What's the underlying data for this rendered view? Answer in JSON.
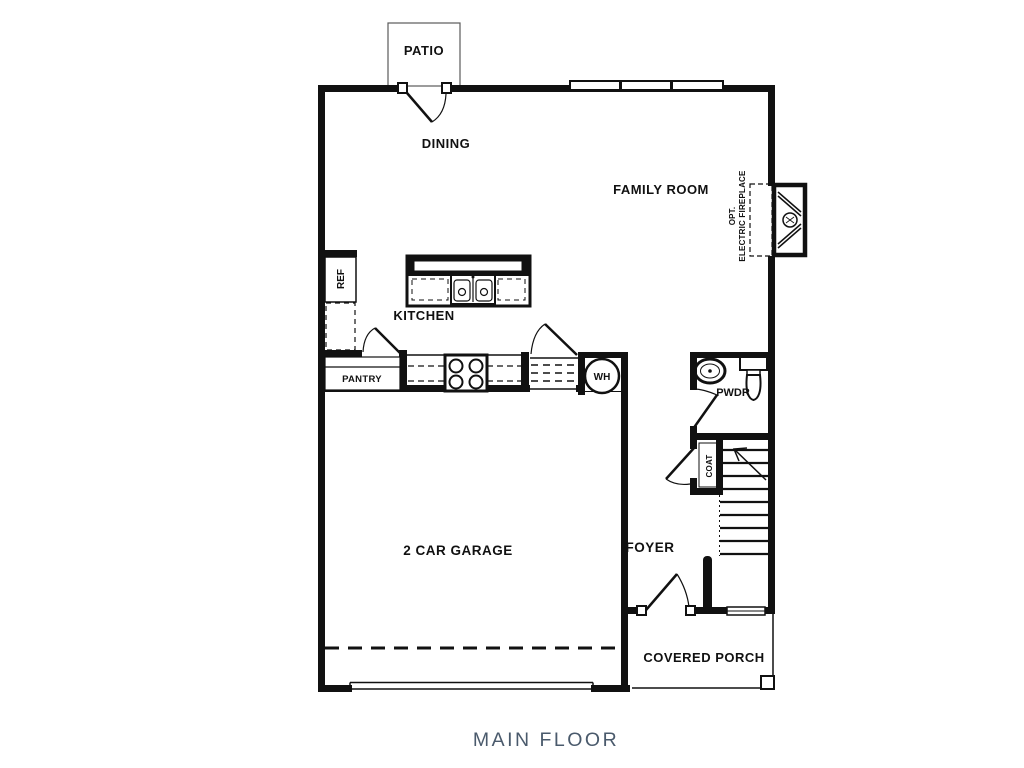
{
  "title": "MAIN FLOOR",
  "colors": {
    "line": "#111111",
    "title_text": "#4a5a6c",
    "paper": "#ffffff"
  },
  "rooms": {
    "patio": "PATIO",
    "dining": "DINING",
    "family_room": "FAMILY ROOM",
    "kitchen": "KITCHEN",
    "pantry": "PANTRY",
    "refrigerator": "REF",
    "water_heater": "WH",
    "powder": "PWDR",
    "coat": "COAT",
    "foyer": "FOYER",
    "garage": "2 CAR GARAGE",
    "covered_porch": "COVERED PORCH"
  },
  "annotations": {
    "fireplace_opt": "OPT.",
    "fireplace_name": "ELECTRIC FIREPLACE"
  },
  "icons": {
    "refrigerator": "refrigerator-icon",
    "kitchen_sink": "double-sink-icon",
    "stove": "stove-icon",
    "water_heater": "water-heater-icon",
    "vanity_sink": "vanity-sink-icon",
    "toilet": "toilet-icon",
    "fireplace": "fireplace-icon",
    "stairs": "staircase-icon",
    "garage_door": "garage-door-icon",
    "door_swing": "door-swing-icon",
    "window": "window-icon"
  }
}
